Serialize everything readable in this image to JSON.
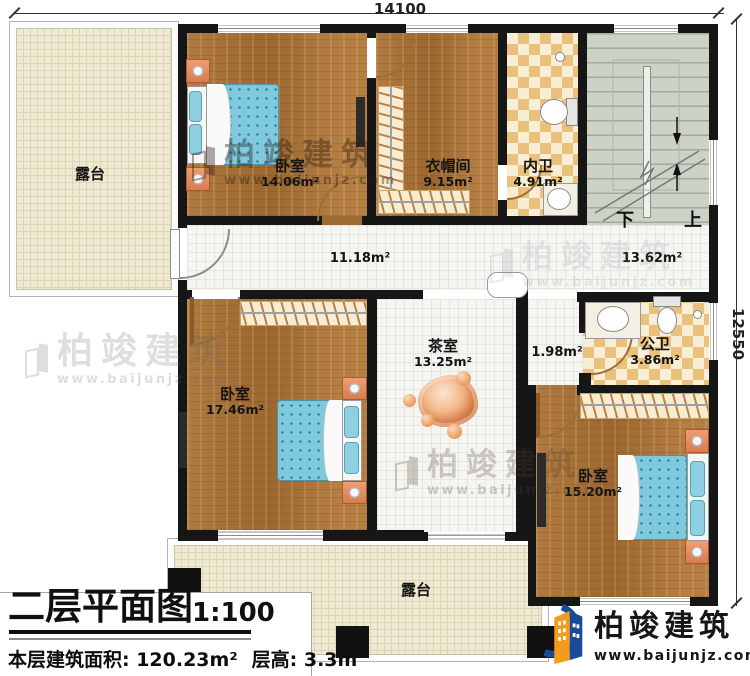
{
  "dimensions": {
    "top": "14100",
    "right": "12550"
  },
  "rooms": {
    "terrace_top": {
      "name": "露台"
    },
    "bedroom1": {
      "name": "卧室",
      "area": "14.06m²"
    },
    "cloakroom": {
      "name": "衣帽间",
      "area": "9.15m²"
    },
    "bath_private": {
      "name": "内卫",
      "area": "4.91m²"
    },
    "corridor": {
      "area": "11.18m²"
    },
    "landing": {
      "area": "13.62m²"
    },
    "bedroom2": {
      "name": "卧室",
      "area": "17.46m²"
    },
    "tearoom": {
      "name": "茶室",
      "area": "13.25m²"
    },
    "hall": {
      "area": "1.98m²"
    },
    "bath_public": {
      "name": "公卫",
      "area": "3.86m²"
    },
    "bedroom3": {
      "name": "卧室",
      "area": "15.20m²"
    },
    "terrace_bottom": {
      "name": "露台"
    }
  },
  "stairs": {
    "down_label": "下",
    "up_label": "上"
  },
  "title_block": {
    "title": "二层平面图",
    "scale": "1:100",
    "area_text": "本层建筑面积: 120.23m²",
    "height_text": "层高: 3.3m"
  },
  "brand": {
    "name": "柏竣建筑",
    "url": "www.baijunjz.com"
  },
  "watermark": {
    "name": "柏竣建筑",
    "url": "www.baijunjz.com"
  },
  "colors": {
    "wall": "#161616",
    "wood": "#a8713a",
    "tile": "#f5f5f2",
    "terrace": "#efe9d2",
    "checker_tan": "#e9c07c",
    "stairs": "#ccd3c6",
    "brand_blue": "#1b4a9b",
    "brand_orange": "#f29b1d"
  }
}
